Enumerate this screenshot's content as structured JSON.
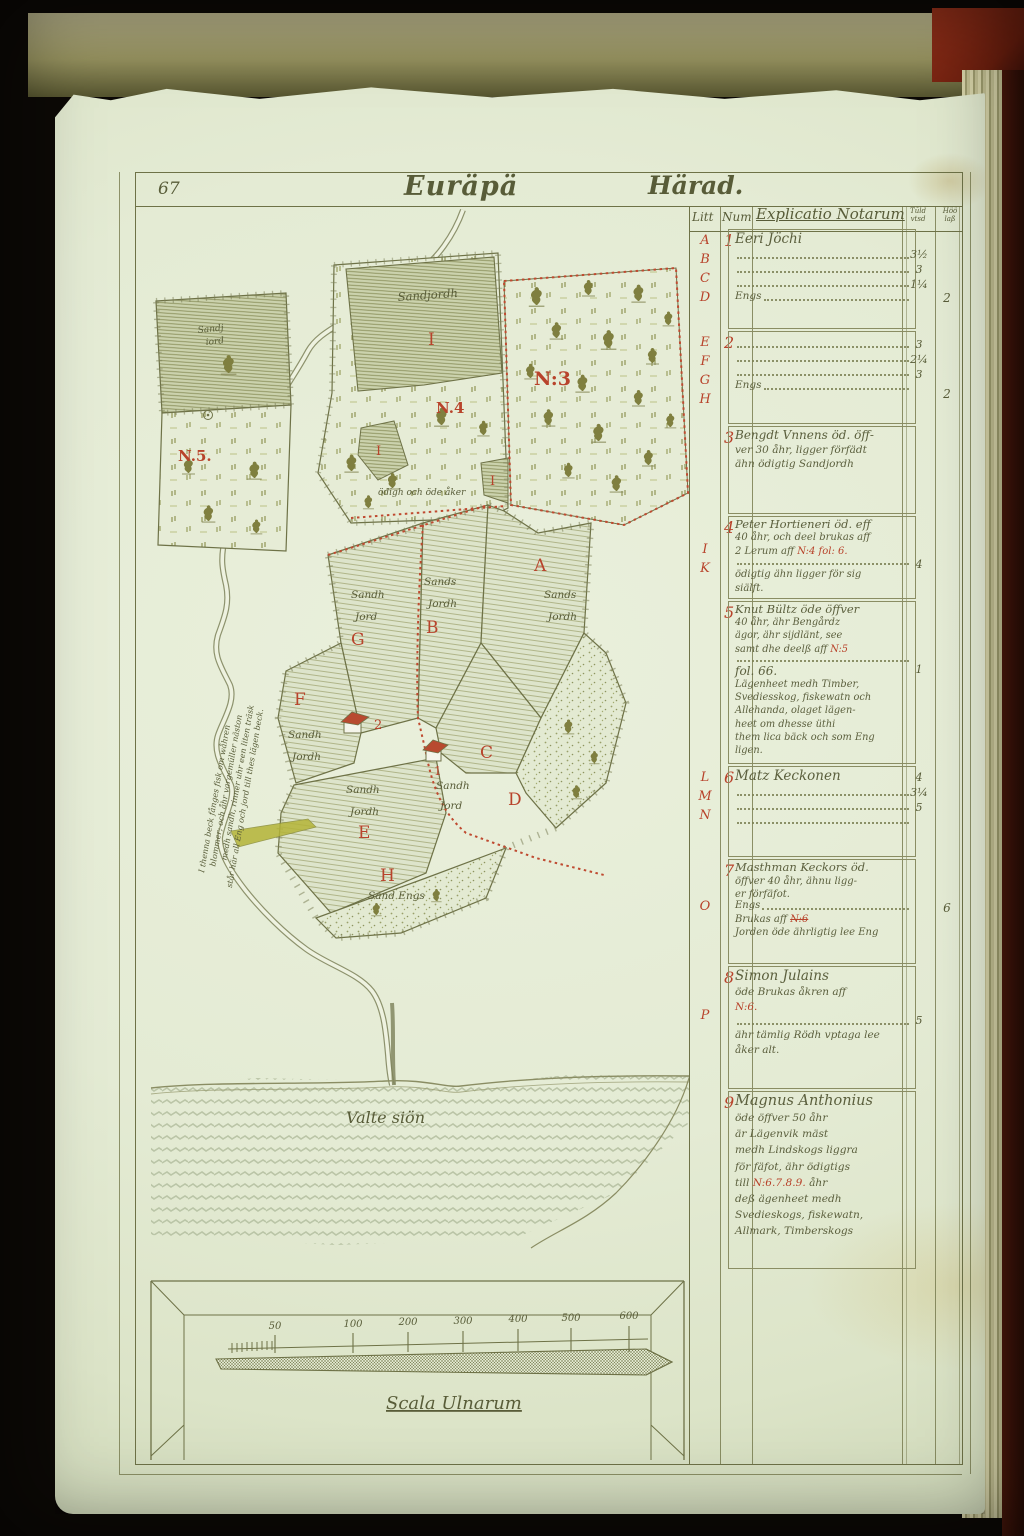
{
  "page": {
    "folio": "67",
    "title": "Euräpä",
    "title_right": "Härad."
  },
  "map": {
    "labels": {
      "inset_soil_1": "Sandj",
      "inset_soil_2": "iord",
      "inset_no": "N.5.",
      "i_soil": "Sandjordh",
      "i_letter": "I",
      "i_small_1": "I",
      "i_small_2": "I",
      "n4": "N.4",
      "odigh": "ödigh och öde åker",
      "n3": "N:3",
      "eng": "Eng.",
      "a": "A",
      "a_soil_1": "Sands",
      "a_soil_2": "Jordh",
      "b": "B",
      "b_soil_1": "Sands",
      "b_soil_2": "Jordh",
      "g": "G",
      "g_soil_1": "Sandh",
      "g_soil_2": "Jord",
      "f": "F",
      "f_soil_1": "Sandh",
      "f_soil_2": "Jordh",
      "c": "C",
      "c_soil_1": "Sandh",
      "c_soil_2": "Jord",
      "d": "D",
      "e": "E",
      "e_soil_1": "Sandh",
      "e_soil_2": "Jordh",
      "h": "H",
      "h_soil": "Sand Engs",
      "house1": "1",
      "house2": "2",
      "lake": "Valte siön",
      "river_note_1": "I thenna beck fånges fisk om wåhren",
      "river_note_2": "blommer; och åhr vargemüller näston",
      "river_note_3": "medh sandh, rinner uhr een liten träsk",
      "river_note_4": "står här all Eng och jord till thes lägen beck."
    },
    "scale": {
      "label": "Scala Ulnarum",
      "ticks": [
        "50",
        "100",
        "200",
        "300",
        "400",
        "500",
        "600"
      ]
    }
  },
  "table": {
    "headers": {
      "litt": "Litt",
      "num": "Num",
      "explicatio": "Explicatio Notarum",
      "c1a": "Tūld",
      "c1b": "vtsd",
      "c2a": "Höö",
      "c2b": "laß"
    },
    "entries": [
      {
        "num": "1",
        "litt": [
          "A",
          "B",
          "C",
          "D"
        ],
        "name": "Eeri Jöchi",
        "tail": "Engs",
        "v1": [
          "3½",
          "3",
          "1¼"
        ],
        "v2": "2"
      },
      {
        "num": "2",
        "litt": [
          "E",
          "F",
          "G",
          "H"
        ],
        "name": "",
        "tail": "Engs",
        "v1": [
          "3",
          "2¼",
          "3"
        ],
        "v2": "2"
      },
      {
        "num": "3",
        "litt": [],
        "lines": [
          "Bengdt Vnnens öd. öff-",
          "ver 30 åhr, ligger förfädt",
          "ähn ödigtig Sandjordh"
        ]
      },
      {
        "num": "4",
        "litt": [
          "I",
          "K"
        ],
        "l1": "Peter Hortieneri öd. eff",
        "l2": "40 åhr, och deel brukas aff",
        "l3pre": "2 Lerum aff ",
        "l3red": "N:4 fol: 6.",
        "l4": "ödigtig ähn ligger för sig",
        "l5": "siälft.",
        "v1": "4"
      },
      {
        "num": "5",
        "litt": [],
        "l1": "Knut Bültz öde öffver",
        "l2": "40 åhr, ähr Bengårdz",
        "l3": "ägor, ähr sijdlänt, see",
        "l4pre": "samt dhe deelß aff ",
        "l4red": "N:5",
        "l5": "fol. 66.",
        "l6": "Lägenheet medh Timber,",
        "l7": "Svediesskog, fiskewatn och",
        "l8": "Allehanda, olaget lägen-",
        "l9": "heet om dhesse üthi",
        "l10": "them lica bäck och som Eng",
        "l11": "ligen.",
        "v1": "1"
      },
      {
        "num": "6",
        "litt": [
          "L",
          "M",
          "N"
        ],
        "name": "Matz Keckonen",
        "v1": [
          "4",
          "3¼",
          "5"
        ]
      },
      {
        "num": "7",
        "litt": [
          "O"
        ],
        "l1": "Masthman Keckors öd.",
        "l2": "öffver 40 åhr, ähnu ligg-",
        "l3": "er förfäfot.",
        "tail": "Engs",
        "l4pre": "Brukas aff ",
        "l4red": "N:6",
        "l5": "Jorden öde ährligtig lee Eng",
        "v2": "6"
      },
      {
        "num": "8",
        "litt": [
          "P"
        ],
        "name": "Simon Julains",
        "l1": "öde Brukas åkren aff",
        "l2red": "N:6.",
        "l3": "ähr tämlig Rödh vptaga lee",
        "l4": "åker alt.",
        "v1": "5"
      },
      {
        "num": "9",
        "litt": [],
        "name": "Magnus Anthonius",
        "l1": "öde öffver 50 åhr",
        "l2": "är Lägenvik mäst",
        "l3": "medh Lindskogs liggra",
        "l4": "för fäfot, ähr ödigtigs",
        "l5pre": "till ",
        "l5red": "N:6.7.8.9.",
        "l5post": " åhr",
        "l6": "deß ägenheet medh",
        "l7": "Svedieskogs, fiskewatn,",
        "l8": "Allmark, Timberskogs"
      }
    ]
  }
}
